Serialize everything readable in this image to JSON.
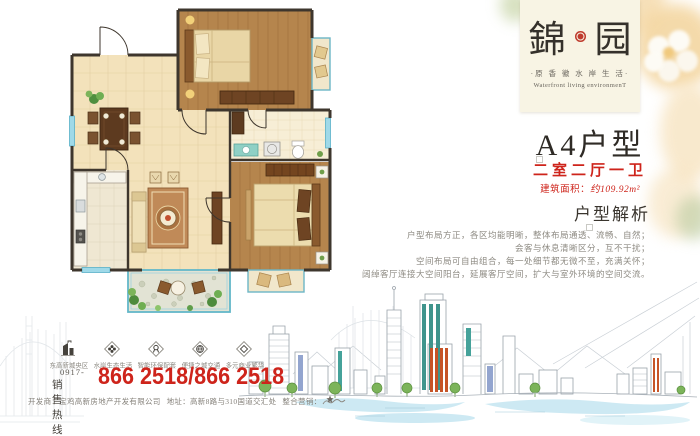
{
  "palette": {
    "accent_red": "#ce241b",
    "seal_red": "#bf3b2d",
    "card_cream": "#f8f4e4",
    "wood_floor": "#b5854d",
    "tile_floor": "#f3e2bb",
    "window_glass": "#9fd9e8",
    "sketch_line": "#9aa2aa",
    "water_blue": "#c5e6f1"
  },
  "logo": {
    "name_left": "錦",
    "name_right": "园",
    "subtitle": "·原 香 徽 水 岸 生 活·",
    "english": "Waterfront living environmenT"
  },
  "unit": {
    "title": "A4户型",
    "layout": "二室二厅一卫",
    "area_label": "建筑面积：",
    "area_value": "约109.92m²"
  },
  "analysis": {
    "heading": "户型解析",
    "lines": [
      "户型布局方正，各区均能明晰，整体布局通透、流畅、自然；",
      "会客与休息清晰区分，互不干扰；",
      "空间布局可自由组合，每一处细节都无微不至，充满关怀；",
      "阔绰客厅连接大空间阳台，延展客厅空间，扩大与室外环境的空间交流。"
    ]
  },
  "features": [
    {
      "icon": "building-icon",
      "label": "东高新城央区"
    },
    {
      "icon": "flower-icon",
      "label": "水岸生态生活"
    },
    {
      "icon": "ribbon-icon",
      "label": "智能环保配套"
    },
    {
      "icon": "globe-icon",
      "label": "便捷之城交通"
    },
    {
      "icon": "gem-icon",
      "label": "多元商业繁华"
    }
  ],
  "hotline": {
    "area_code": "0917-",
    "label": "销售热线",
    "numbers": "866 2518/866 2518"
  },
  "footer": {
    "developer": "开发商：宝鸡高新房地产开发有限公司",
    "address": "地址：高新8路与310国道交汇处",
    "marketing_label": "整合营销："
  }
}
